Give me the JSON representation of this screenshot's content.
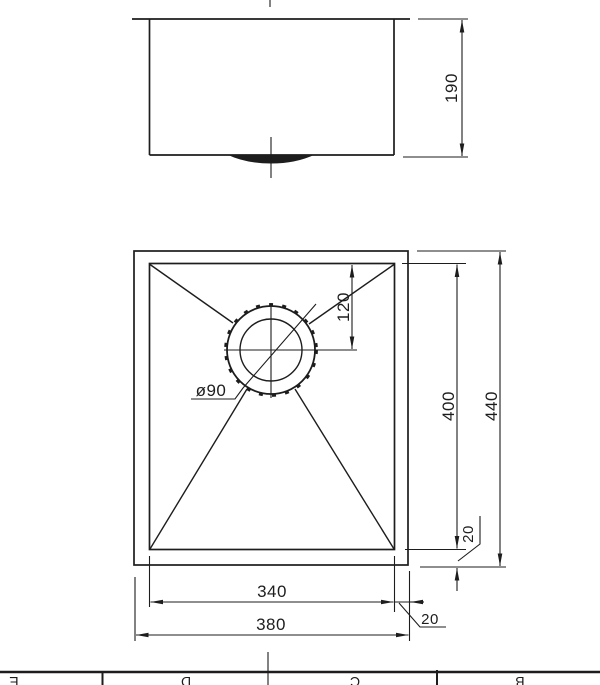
{
  "colors": {
    "ink": "#1d1d1d",
    "background": "#ffffff"
  },
  "dimensions": {
    "elevation_height": "190",
    "drain_center_offset": "120",
    "drain_diameter": "ø90",
    "bowl_length": "400",
    "overall_length": "440",
    "rim_right": "20",
    "bowl_width": "340",
    "overall_width": "380",
    "rim_bottom": "20"
  },
  "frame": {
    "zone_labels": [
      "E",
      "D",
      "C",
      "B"
    ]
  }
}
